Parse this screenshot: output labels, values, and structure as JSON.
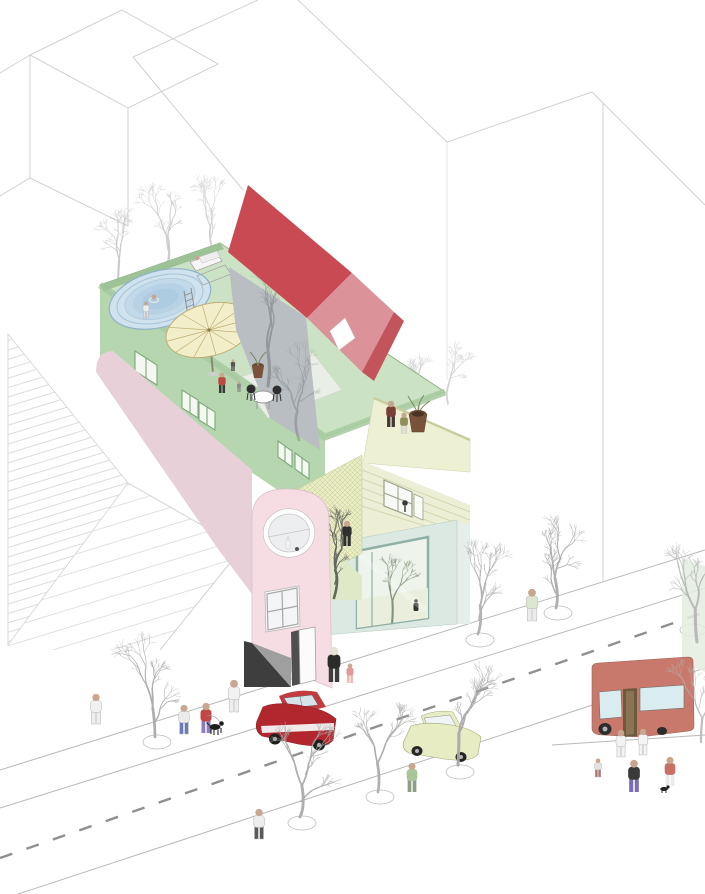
{
  "scene": {
    "kind": "architectural axonometric illustration",
    "subject": "colorful infill apartment building with rooftop pool terrace on a tree-lined street"
  },
  "palette": {
    "outline": "#d2d2d2",
    "street-line": "#b9b9b9",
    "dash": "#8f8f8f",
    "deck-floor": "#cbe3c4",
    "deck-wall": "#b5d6af",
    "parapet": "#a8cba2",
    "parapet-top": "#9cc296",
    "terrace-floor": "#e9eee6",
    "pool-rim": "#cfe2ee",
    "pool-stroke": "#8fb2cc",
    "umbrella": "#f3eeca",
    "umbrella-rib": "#bfae74",
    "roof-red": "#c94a52",
    "roof-red-light": "#db9298",
    "roof-red-dark": "#c4545c",
    "wall-gray": "#b9bec3",
    "band-pink": "#e7d0d8",
    "tower-pink": "#f6dde4",
    "terrace-yellow": "#eef0d4",
    "siding": "#ecefd6",
    "siding-line": "#cdd2a8",
    "hatchwall": "#e9ecc4",
    "court-floor": "#dfe9c8",
    "mint": "#dce9e3",
    "mint-frame": "#8fb0a6",
    "mint-glass": "#eef4ec",
    "mint-side": "#e6efe9",
    "car-red": "#b2272e",
    "car-red-roof": "#c23b41",
    "car-window": "#d7e3ea",
    "car-yellow": "#e8ecc2",
    "bus-body": "#c9796b",
    "bus-window": "#d9ecf0",
    "bus-door": "#6d5a3e",
    "bus-door-panel": "#8a7454",
    "pot-brown": "#7a523a",
    "chair-dark": "#2e2e2e",
    "skin": "#c9a690"
  },
  "vehicles": [
    {
      "name": "red-car",
      "color": "#b2272e"
    },
    {
      "name": "yellow-car",
      "color": "#e8ecc2"
    },
    {
      "name": "bus",
      "color": "#c9796b"
    }
  ],
  "people": [
    {
      "name": "rooftop-person-red",
      "x": 222,
      "y": 393,
      "h": 21,
      "top": "#bf4a43",
      "bottom": "#3a3a3a"
    },
    {
      "name": "rooftop-person-small-1",
      "x": 233,
      "y": 371,
      "h": 12,
      "top": "#555555",
      "bottom": "#555555"
    },
    {
      "name": "rooftop-person-small-2",
      "x": 239,
      "y": 392,
      "h": 11,
      "top": "#8a8a8a",
      "bottom": "#8a8a8a"
    },
    {
      "name": "pool-edge-person",
      "x": 146,
      "y": 318,
      "h": 17,
      "top": "#ededed",
      "bottom": "#e0e0e0",
      "outline": true
    },
    {
      "name": "terrace-person-brown",
      "x": 391,
      "y": 427,
      "h": 27,
      "top": "#7a4038",
      "bottom": "#433935"
    },
    {
      "name": "terrace-person-olive",
      "x": 404,
      "y": 434,
      "h": 22,
      "top": "#8f8f5a",
      "bottom": "#d8d8cc"
    },
    {
      "name": "climbing-person",
      "x": 347,
      "y": 546,
      "h": 26,
      "top": "#2f2f2f",
      "bottom": "#2f2f2f"
    },
    {
      "name": "entrance-man",
      "x": 334,
      "y": 682,
      "h": 36,
      "top": "#2b2b2b",
      "bottom": "#3d3d3d",
      "head": "#e9e2d2"
    },
    {
      "name": "entrance-child",
      "x": 350,
      "y": 683,
      "h": 20,
      "top": "#e09a9a",
      "bottom": "#eab6ae"
    },
    {
      "name": "sidewalk-person-white",
      "x": 234,
      "y": 712,
      "h": 33,
      "top": "#f1f1f1",
      "bottom": "#ededed",
      "outline": true
    },
    {
      "name": "sidewalk-person-blue",
      "x": 184,
      "y": 734,
      "h": 30,
      "top": "#ebebeb",
      "bottom": "#6d79c1",
      "outline": true
    },
    {
      "name": "dog-walker",
      "x": 206,
      "y": 733,
      "h": 31,
      "top": "#c14744",
      "bottom": "#8d7cba"
    },
    {
      "name": "crossing-person",
      "x": 259,
      "y": 839,
      "h": 31,
      "top": "#ededed",
      "bottom": "#5a5a5a",
      "outline": true
    },
    {
      "name": "crossing-person-green",
      "x": 412,
      "y": 792,
      "h": 30,
      "top": "#a9c699",
      "bottom": "#8e9e84"
    },
    {
      "name": "curbside-person",
      "x": 532,
      "y": 621,
      "h": 33,
      "top": "#dde6d0",
      "bottom": "#ebebeb",
      "outline": true
    },
    {
      "name": "bus-stop-person-dark",
      "x": 634,
      "y": 792,
      "h": 33,
      "top": "#3a3a3a",
      "bottom": "#7a6cb2"
    },
    {
      "name": "bus-stop-person-white-1",
      "x": 621,
      "y": 757,
      "h": 28,
      "top": "#f2f2f2",
      "bottom": "#f2f2f2",
      "outline": true
    },
    {
      "name": "bus-stop-person-white-2",
      "x": 643,
      "y": 755,
      "h": 27,
      "top": "#f5f5f5",
      "bottom": "#f5f5f5",
      "outline": true
    },
    {
      "name": "bus-stop-person-rose",
      "x": 670,
      "y": 786,
      "h": 30,
      "top": "#c96f64",
      "bottom": "#ebebeb"
    },
    {
      "name": "bus-stop-person-small",
      "x": 598,
      "y": 777,
      "h": 19,
      "top": "#e2e2e2",
      "bottom": "#b86e6e",
      "outline": true
    },
    {
      "name": "sidewalk-person-far-left",
      "x": 96,
      "y": 724,
      "h": 31,
      "top": "#f1f1f1",
      "bottom": "#ededed",
      "outline": true
    }
  ],
  "trees": {
    "bg": [
      {
        "name": "bg-tree-1",
        "x": 118,
        "y": 282,
        "h": 66,
        "color": "#c5c5c5",
        "op": 0.9,
        "seed": 3
      },
      {
        "name": "bg-tree-2",
        "x": 168,
        "y": 262,
        "h": 72,
        "color": "#c8c8c8",
        "op": 0.9,
        "seed": 7
      },
      {
        "name": "bg-tree-3",
        "x": 212,
        "y": 247,
        "h": 60,
        "color": "#cbcbcb",
        "op": 0.85,
        "seed": 11
      },
      {
        "name": "bg-tree-4",
        "x": 416,
        "y": 430,
        "h": 74,
        "color": "#c9c9c9",
        "op": 0.9,
        "seed": 13
      },
      {
        "name": "bg-tree-5",
        "x": 448,
        "y": 404,
        "h": 58,
        "color": "#cdcdcd",
        "op": 0.85,
        "seed": 17
      }
    ],
    "shadow": [
      {
        "name": "wall-shadow-tree-1",
        "x": 268,
        "y": 386,
        "h": 100,
        "color": "#3f3f3f",
        "op": 0.3,
        "seed": 19
      },
      {
        "name": "wall-shadow-tree-2",
        "x": 299,
        "y": 440,
        "h": 84,
        "color": "#3f3f3f",
        "op": 0.24,
        "seed": 23
      }
    ],
    "court": [
      {
        "name": "courtyard-tree",
        "x": 334,
        "y": 598,
        "h": 82,
        "color": "#4f4f4f",
        "op": 0.85,
        "seed": 29
      }
    ],
    "interior": [
      {
        "name": "atrium-tree",
        "x": 392,
        "y": 624,
        "h": 66,
        "color": "#77896d",
        "op": 0.9,
        "seed": 31
      }
    ],
    "street": [
      {
        "name": "street-tree-1",
        "x": 155,
        "y": 737,
        "h": 86,
        "color": "#aaaaaa",
        "op": 0.95,
        "seed": 37
      },
      {
        "name": "street-tree-2",
        "x": 300,
        "y": 817,
        "h": 92,
        "color": "#ababab",
        "op": 0.95,
        "seed": 41
      },
      {
        "name": "street-tree-3",
        "x": 458,
        "y": 765,
        "h": 94,
        "color": "#a8a8a8",
        "op": 0.95,
        "seed": 43
      },
      {
        "name": "street-tree-4",
        "x": 556,
        "y": 608,
        "h": 88,
        "color": "#ababab",
        "op": 0.95,
        "seed": 47
      },
      {
        "name": "street-tree-5",
        "x": 478,
        "y": 634,
        "h": 84,
        "color": "#aeaeae",
        "op": 0.95,
        "seed": 53
      },
      {
        "name": "street-tree-6",
        "x": 378,
        "y": 792,
        "h": 84,
        "color": "#ababab",
        "op": 0.95,
        "seed": 59
      },
      {
        "name": "street-tree-7",
        "x": 697,
        "y": 642,
        "h": 96,
        "color": "#b2b2b2",
        "op": 0.9,
        "seed": 61
      },
      {
        "name": "street-tree-8",
        "x": 701,
        "y": 742,
        "h": 70,
        "color": "#b5b5b5",
        "op": 0.85,
        "seed": 67
      }
    ]
  }
}
